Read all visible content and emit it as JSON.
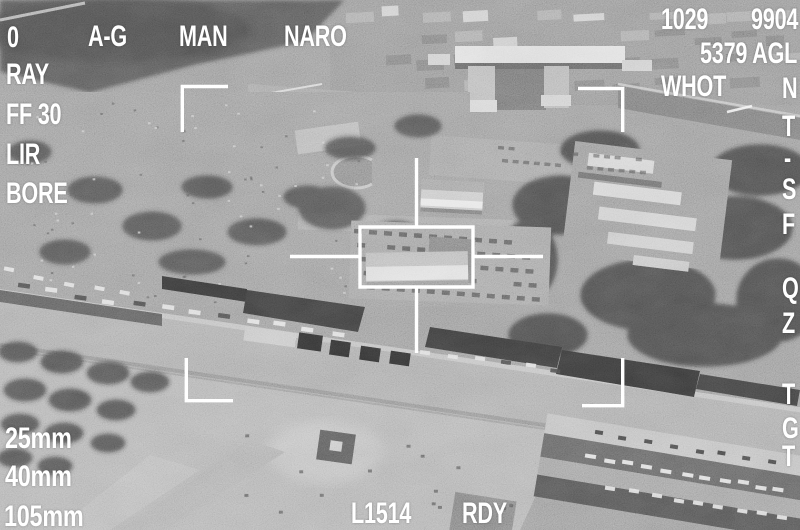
{
  "hud": {
    "top_bar": {
      "left_digit": "0",
      "master_mode": "A-G",
      "track_mode": "MAN",
      "fov": "NARO"
    },
    "left_column": [
      "RAY",
      "FF 30",
      "LIR",
      "BORE"
    ],
    "top_right": {
      "clock": "1029",
      "code": "9904",
      "altitude": "5379 AGL",
      "polarity": "WHOT"
    },
    "right_column": [
      "N",
      "T",
      "-",
      "S",
      "F",
      "Q",
      "Z",
      "T",
      "G",
      "T"
    ],
    "weapons": [
      "25mm",
      "40mm",
      "105mm"
    ],
    "bottom_bar": {
      "laser_code": "L1514",
      "status": "RDY"
    },
    "colors": {
      "hud_text": "#ffffff"
    }
  }
}
